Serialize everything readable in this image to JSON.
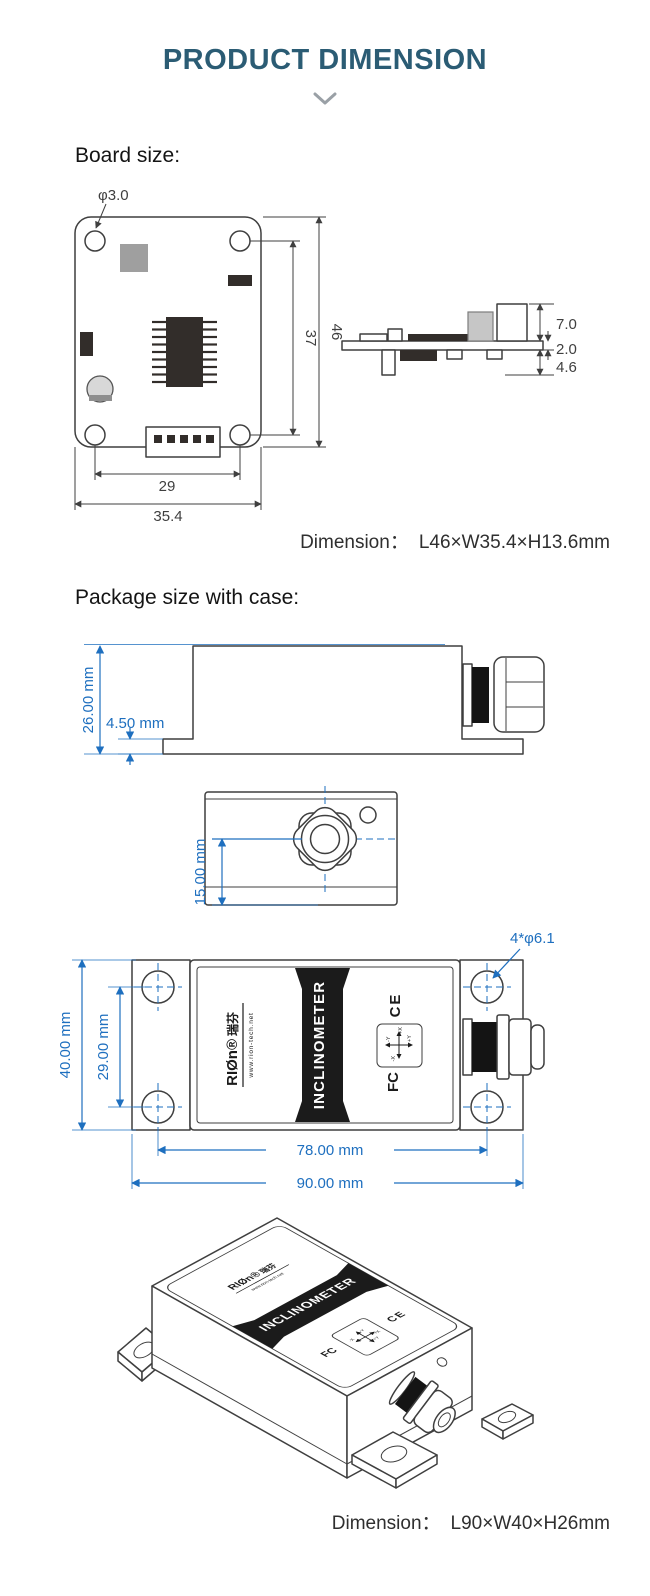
{
  "header": {
    "title": "PRODUCT DIMENSION"
  },
  "board_section": {
    "heading": "Board size:",
    "top_view": {
      "hole_diameter": "φ3.0",
      "pcb_inner_height": "37",
      "pcb_height": "46",
      "connector_width": "29",
      "pcb_width": "35.4"
    },
    "side_view": {
      "component_height_top": "7.0",
      "board_thickness": "2.0",
      "component_height_bottom": "4.6"
    },
    "summary": {
      "label": "Dimension：",
      "value": "L46×W35.4×H13.6mm"
    }
  },
  "package_section": {
    "heading": "Package size with case:",
    "side_view": {
      "case_height": "26.00 mm",
      "base_thickness": "4.50 mm"
    },
    "front_view": {
      "gland_center_height": "15.00 mm"
    },
    "top_view": {
      "case_width": "40.00 mm",
      "hole_spacing_width": "29.00 mm",
      "hole_spacing_length": "78.00 mm",
      "case_length": "90.00 mm",
      "mounting_holes": "4*φ6.1"
    },
    "device_label": {
      "brand": "RIØn®",
      "brand_cn": "瑞芬",
      "website": "www.rion-tech.net",
      "product_name": "INCLINOMETER",
      "ce_mark": "CE",
      "fcc_mark": "FC",
      "axis_labels": [
        "+X",
        "-Y",
        "-X",
        "+Y"
      ]
    },
    "summary": {
      "label": "Dimension：",
      "value": "L90×W40×H26mm"
    }
  },
  "colors": {
    "title": "#2b5c74",
    "dimension_blue": "#1e6fbf",
    "line_dark": "#3f3f3f"
  }
}
